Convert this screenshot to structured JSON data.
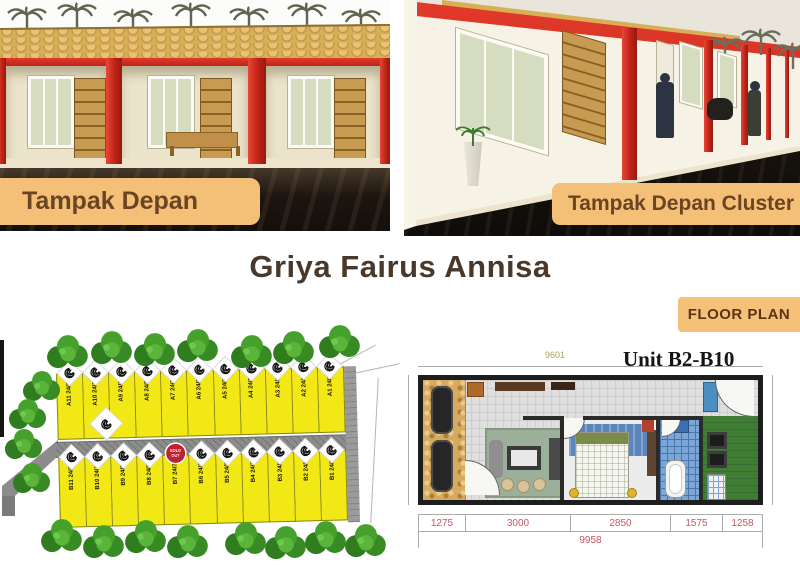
{
  "title": "Griya Fairus Annisa",
  "captions": {
    "left": "Tampak Depan",
    "right": "Tampak Depan Cluster",
    "floor_plan": "FLOOR PLAN"
  },
  "colors": {
    "accent_red": "#d3271f",
    "label_bg": "#f4bf76",
    "label_text": "#6b4423",
    "title_text": "#4a392b",
    "lot_yellow": "#f2e815",
    "road_gray": "#8c8c8c",
    "tree_green": "#3e9023",
    "dim_red": "#c9565e",
    "dim_olive": "#a9a65e"
  },
  "siteplan": {
    "rows": {
      "top": [
        {
          "id": "A11",
          "size": "24/24",
          "mark": "spiral"
        },
        {
          "id": "A10",
          "size": "24/26",
          "mark": "spiral"
        },
        {
          "id": "A9",
          "size": "24/25",
          "mark": "spiral"
        },
        {
          "id": "A8",
          "size": "24/25",
          "mark": "spiral"
        },
        {
          "id": "A7",
          "size": "24/25",
          "mark": "spiral"
        },
        {
          "id": "A6",
          "size": "24/25",
          "mark": "spiral"
        },
        {
          "id": "A5",
          "size": "24/25",
          "mark": "spiral"
        },
        {
          "id": "A4",
          "size": "24/25",
          "mark": "spiral"
        },
        {
          "id": "A3",
          "size": "24/25",
          "mark": "spiral"
        },
        {
          "id": "A2",
          "size": "24/25",
          "mark": "spiral"
        },
        {
          "id": "A1",
          "size": "24/35",
          "mark": "spiral"
        }
      ],
      "bottom": [
        {
          "id": "B11",
          "size": "24/24",
          "mark": "spiral"
        },
        {
          "id": "B10",
          "size": "24/30",
          "mark": "spiral"
        },
        {
          "id": "B9",
          "size": "24/30",
          "mark": "spiral"
        },
        {
          "id": "B8",
          "size": "24/30",
          "mark": "spiral"
        },
        {
          "id": "B7",
          "size": "24/30",
          "mark": "badge"
        },
        {
          "id": "B6",
          "size": "24/30",
          "mark": "spiral"
        },
        {
          "id": "B5",
          "size": "24/30",
          "mark": "spiral"
        },
        {
          "id": "B4",
          "size": "24/30",
          "mark": "spiral"
        },
        {
          "id": "B3",
          "size": "24/30",
          "mark": "spiral"
        },
        {
          "id": "B2",
          "size": "24/30",
          "mark": "spiral"
        },
        {
          "id": "B1",
          "size": "24/36",
          "mark": "spiral"
        }
      ]
    },
    "badge_line1": "SOLD",
    "badge_line2": "OUT"
  },
  "floorplan": {
    "unit_label": "Unit B2-B10",
    "dim_top": "9601",
    "dim_right": "3008",
    "dims_bottom": [
      "1275",
      "3000",
      "2850",
      "1575",
      "1258"
    ],
    "dim_total": "9958"
  }
}
